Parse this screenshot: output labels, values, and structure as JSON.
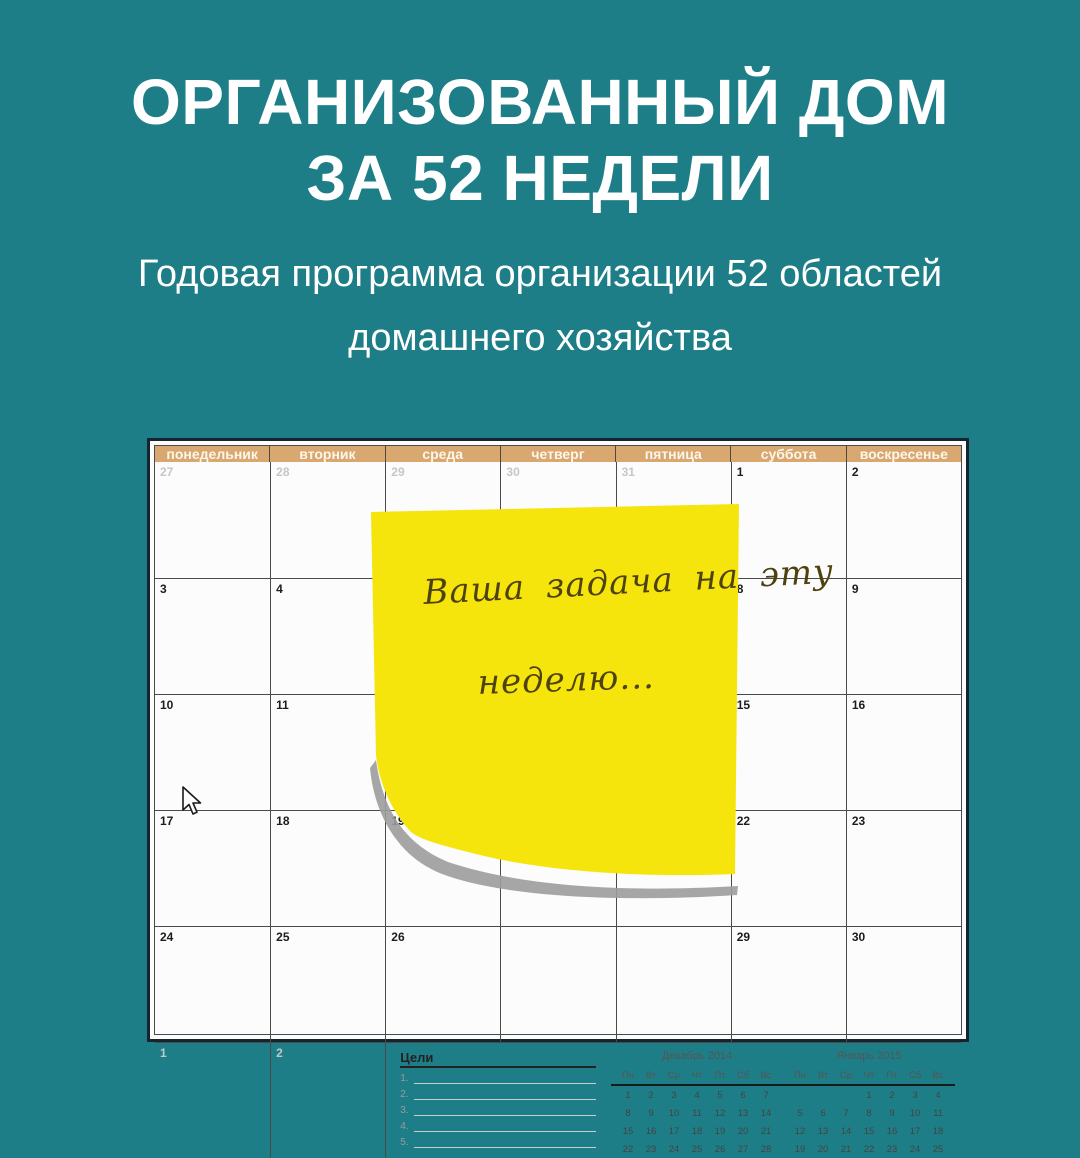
{
  "colors": {
    "background": "#1e7e87",
    "header_tan": "#d9a870",
    "note_yellow": "#f5e50c",
    "note_ink": "#4e420e",
    "shadow_gray": "#9c9c9c"
  },
  "titles": {
    "line1": "ОРГАНИЗОВАННЫЙ ДОМ",
    "line2": "ЗА 52 НЕДЕЛИ",
    "subtitle1": "Годовая программа организации 52 областей",
    "subtitle2": "домашнего хозяйства"
  },
  "calendar": {
    "day_headers": [
      "понедельник",
      "вторник",
      "среда",
      "четверг",
      "пятница",
      "суббота",
      "воскресенье"
    ],
    "rows": [
      [
        {
          "t": "27",
          "m": true
        },
        {
          "t": "28",
          "m": true
        },
        {
          "t": "29",
          "m": true
        },
        {
          "t": "30",
          "m": true
        },
        {
          "t": "31",
          "m": true
        },
        {
          "t": "1"
        },
        {
          "t": "2"
        }
      ],
      [
        {
          "t": "3"
        },
        {
          "t": "4"
        },
        {
          "t": ""
        },
        {
          "t": ""
        },
        {
          "t": ""
        },
        {
          "t": "8"
        },
        {
          "t": "9"
        }
      ],
      [
        {
          "t": "10"
        },
        {
          "t": "11"
        },
        {
          "t": ""
        },
        {
          "t": ""
        },
        {
          "t": ""
        },
        {
          "t": "15"
        },
        {
          "t": "16"
        }
      ],
      [
        {
          "t": "17"
        },
        {
          "t": "18"
        },
        {
          "t": "19"
        },
        {
          "t": ""
        },
        {
          "t": ""
        },
        {
          "t": "22"
        },
        {
          "t": "23"
        }
      ],
      [
        {
          "t": "24"
        },
        {
          "t": "25"
        },
        {
          "t": "26"
        },
        {
          "t": ""
        },
        {
          "t": ""
        },
        {
          "t": "29"
        },
        {
          "t": "30"
        }
      ],
      [
        {
          "t": "1",
          "m": true
        },
        {
          "t": "2",
          "m": true
        }
      ]
    ],
    "goals": {
      "label": "Цели",
      "line_numbers": [
        "1.",
        "2.",
        "3.",
        "4.",
        "5."
      ]
    },
    "minicals": [
      {
        "title": "Декабрь 2014",
        "days": [
          "Пн",
          "Вт",
          "Ср",
          "Чт",
          "Пт",
          "Сб",
          "Вс"
        ],
        "weeks": [
          [
            "1",
            "2",
            "3",
            "4",
            "5",
            "6",
            "7"
          ],
          [
            "8",
            "9",
            "10",
            "11",
            "12",
            "13",
            "14"
          ],
          [
            "15",
            "16",
            "17",
            "18",
            "19",
            "20",
            "21"
          ],
          [
            "22",
            "23",
            "24",
            "25",
            "26",
            "27",
            "28"
          ]
        ]
      },
      {
        "title": "Январь 2015",
        "days": [
          "Пн",
          "Вт",
          "Ср",
          "Чт",
          "Пт",
          "Сб",
          "Вс"
        ],
        "weeks": [
          [
            "",
            "",
            "",
            "1",
            "2",
            "3",
            "4"
          ],
          [
            "5",
            "6",
            "7",
            "8",
            "9",
            "10",
            "11"
          ],
          [
            "12",
            "13",
            "14",
            "15",
            "16",
            "17",
            "18"
          ],
          [
            "19",
            "20",
            "21",
            "22",
            "23",
            "24",
            "25"
          ]
        ]
      }
    ]
  },
  "sticky_note": {
    "line1": "Ваша задача на эту",
    "line2": "неделю..."
  }
}
